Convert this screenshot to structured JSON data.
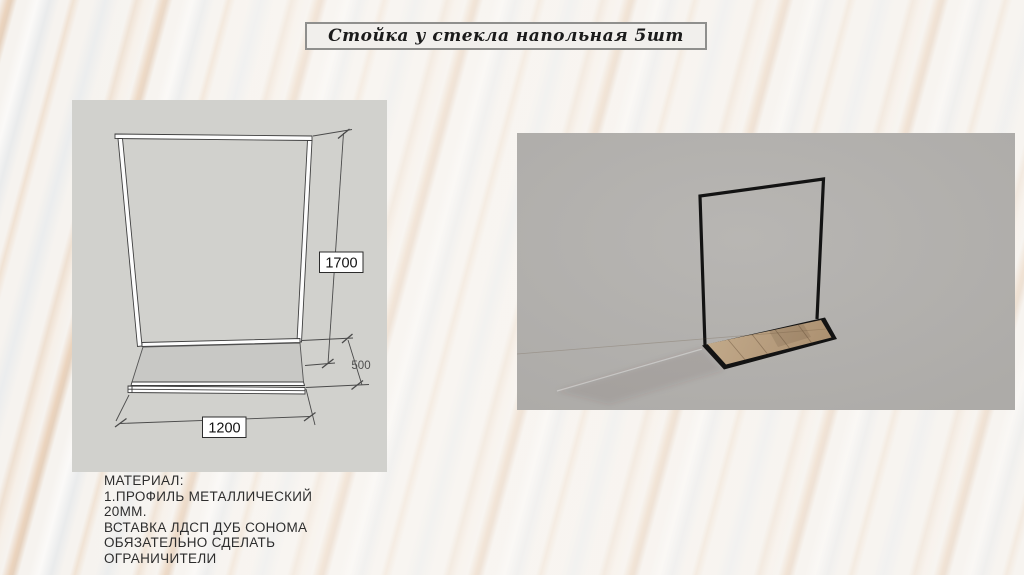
{
  "slide": {
    "title": "Стойка у стекла напольная 5шт"
  },
  "drawing_panel": {
    "description": "dimensioned sketch of floor stand",
    "dimensions": {
      "height_mm": "1700",
      "depth_mm": "500",
      "width_mm": "1200"
    }
  },
  "render_panel": {
    "description": "3d render of black metal stand with wood base"
  },
  "material_note": {
    "line1": "МАТЕРИАЛ:",
    "line2": "1.ПРОФИЛЬ МЕТАЛЛИЧЕСКИЙ",
    "line3": "20ММ.",
    "line4": "ВСТАВКА ЛДСП ДУБ СОНОМА",
    "line5": "ОБЯЗАТЕЛЬНО СДЕЛАТЬ",
    "line6": "ОГРАНИЧИТЕЛИ"
  },
  "colors": {
    "drawing_panel_bg": "#d1d1cd",
    "render_panel_bg": "#b2b0ad",
    "frame_black": "#131313",
    "wood": "#b79d7e",
    "marble_vein": "#d9a87c",
    "title_box_bg": "#f1efec"
  }
}
